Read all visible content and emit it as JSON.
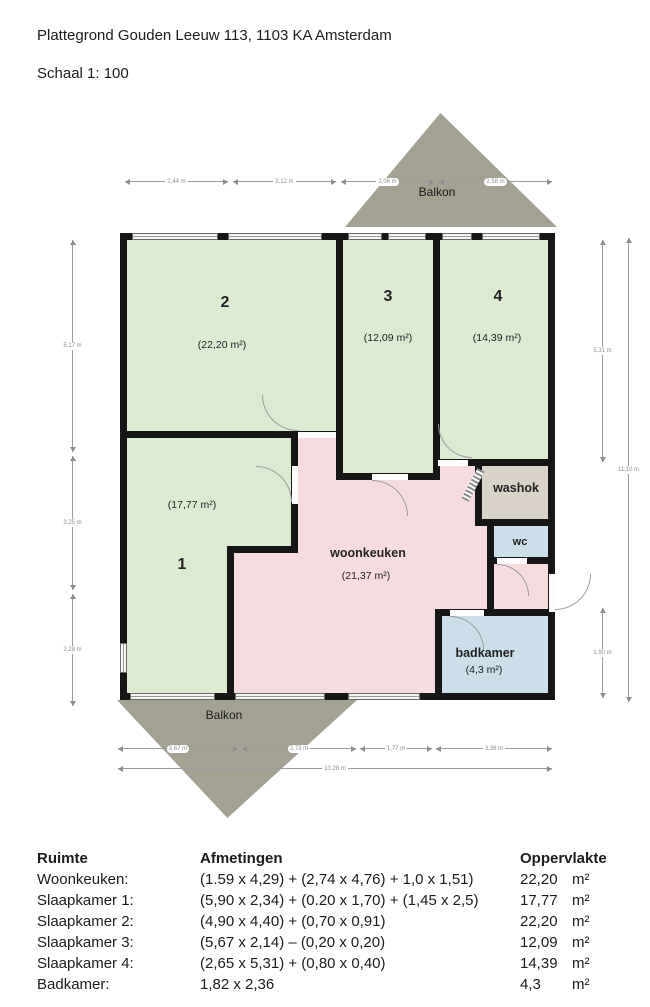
{
  "header": {
    "title": "Plattegrond Gouden Leeuw 113, 1103 KA Amsterdam",
    "scale": "Schaal 1: 100"
  },
  "plan": {
    "balkon_top": "Balkon",
    "balkon_bottom": "Balkon",
    "rooms": {
      "slaapkamer2": {
        "number": "2",
        "area": "(22,20 m²)"
      },
      "slaapkamer3": {
        "number": "3",
        "area": "(12,09 m²)"
      },
      "slaapkamer4": {
        "number": "4",
        "area": "(14,39 m²)"
      },
      "slaapkamer1": {
        "number": "1",
        "area": "(17,77 m²)"
      },
      "woonkeuken": {
        "name": "woonkeuken",
        "area": "(21,37 m²)"
      },
      "washok": {
        "name": "washok"
      },
      "wc": {
        "name": "wc"
      },
      "badkamer": {
        "name": "badkamer",
        "area": "(4,3 m²)"
      }
    },
    "dimensions": {
      "top": [
        "2,44 m",
        "2,12 m",
        "2,06 m",
        "2,58 m"
      ],
      "left": [
        "5,17 m",
        "3,25 m",
        "2,28 m"
      ],
      "right": [
        "5,31 m",
        "1,90 m"
      ],
      "right_total": "11,10 m",
      "bottom": [
        "2,67 m",
        "2,73 m",
        "1,77 m",
        "3,36 m"
      ],
      "bottom_total": "10,28 m"
    },
    "colors": {
      "bedroom_green": "#dcead2",
      "kitchen_pink": "#f6dcde",
      "washok_tan": "#d9d2c8",
      "bath_blue": "#cadfe9",
      "balcony_olive": "#a3a292",
      "wall_black": "#161616"
    }
  },
  "table": {
    "headers": {
      "ruimte": "Ruimte",
      "afmetingen": "Afmetingen",
      "oppervlakte": "Oppervlakte"
    },
    "rows": [
      {
        "ruimte": "Woonkeuken:",
        "afmetingen": "(1.59 x 4,29) + (2,74 x 4,76) + 1,0 x 1,51)",
        "oppervlakte": "22,20",
        "unit": "m²"
      },
      {
        "ruimte": "Slaapkamer 1:",
        "afmetingen": "(5,90 x 2,34) + (0.20 x 1,70) + (1,45 x 2,5)",
        "oppervlakte": "17,77",
        "unit": "m²"
      },
      {
        "ruimte": "Slaapkamer 2:",
        "afmetingen": "(4,90 x 4,40) + (0,70 x 0,91)",
        "oppervlakte": "22,20",
        "unit": "m²"
      },
      {
        "ruimte": "Slaapkamer 3:",
        "afmetingen": "(5,67 x 2,14) – (0,20 x 0,20)",
        "oppervlakte": "12,09",
        "unit": "m²"
      },
      {
        "ruimte": "Slaapkamer 4:",
        "afmetingen": "(2,65 x 5,31) + (0,80 x 0,40)",
        "oppervlakte": "14,39",
        "unit": "m²"
      },
      {
        "ruimte": "Badkamer:",
        "afmetingen": "1,82 x 2,36",
        "oppervlakte": "4,3",
        "unit": "m²"
      }
    ]
  }
}
